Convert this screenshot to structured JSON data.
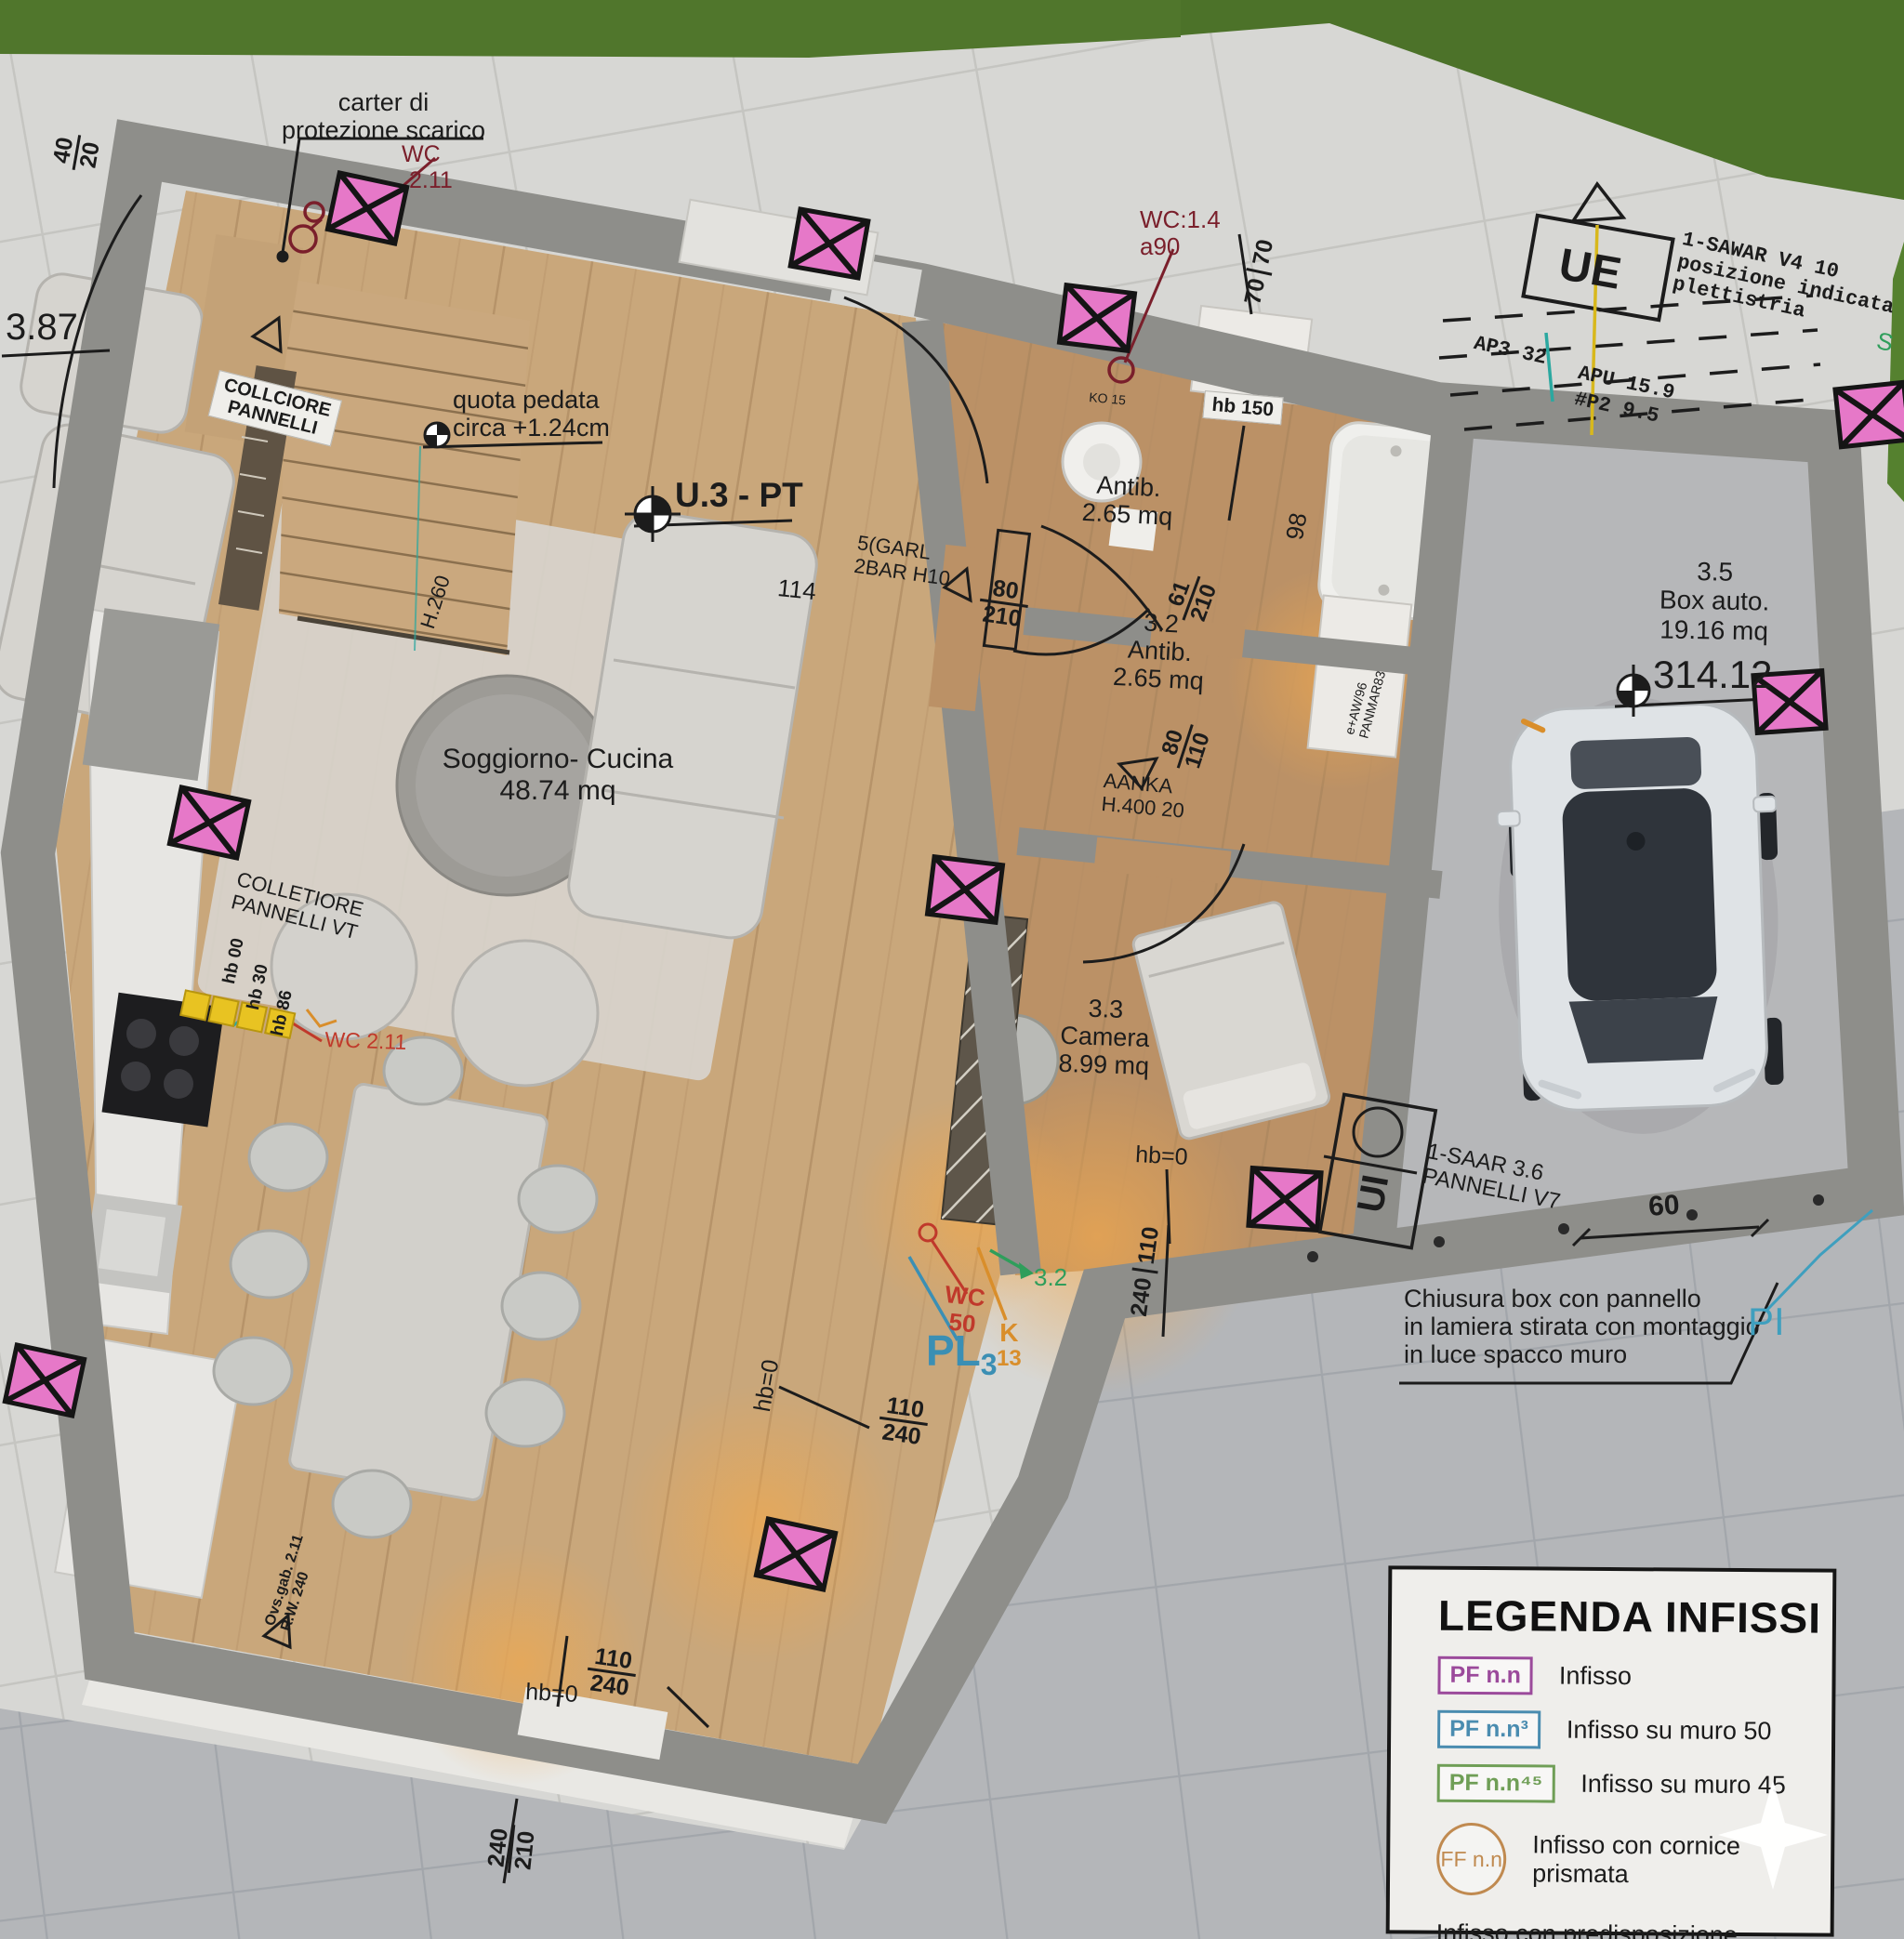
{
  "plan_title": "U.3 - PT",
  "rooms": {
    "living": {
      "name": "Soggiorno- Cucina",
      "area": "48.74 mq",
      "number": "114"
    },
    "antib1": {
      "name": "Antib.",
      "area": "2.65 mq",
      "side_dim": "98"
    },
    "antib2": {
      "number": "3.2",
      "name": "Antib.",
      "area": "2.65 mq"
    },
    "camera": {
      "number": "3.3",
      "name": "Camera",
      "area": "8.99 mq"
    },
    "garage": {
      "number": "3.5",
      "name": "Box auto.",
      "area": "19.16 mq",
      "spot_elevation": "314.12"
    }
  },
  "annotations": {
    "carter1": "carter di",
    "carter2": "protezione scarico",
    "wc_top1": "WC",
    "wc_top2": "2.11",
    "d387": "3.87",
    "collciore1": "COLLCIORE",
    "collciore2": "PANNELLI",
    "quota1": "quota pedata",
    "quota2": "circa +1.24cm",
    "h260": "H.260",
    "garl1": "5(GARL",
    "garl2": "2BAR H10",
    "wc14": "WC:1.4",
    "a90": "a90",
    "ko15": "KO 15",
    "hb150": "hb 150",
    "anka1": "AANKA",
    "anka2": "H.400  20",
    "wardrobe1": "e+AW/96",
    "wardrobe2": "PANMAR83",
    "ue": "UE",
    "sawar1": "1-SAWAR V4 10",
    "sawar2": "posizione indicata",
    "sawar3": "plettistria",
    "ap3": "AP3 32",
    "apu": "APU 15.9",
    "p2": "#P2 9.5",
    "s": "S",
    "colletiore1": "COLLETIORE",
    "colletiore2": "PANNELLI VT",
    "hb00": "hb 00",
    "hb30": "hb 30",
    "hb86": "hb 86",
    "wc_kitchen": "WC 2.11",
    "hb0": "hb=0",
    "ui": "UI",
    "saar1": "1-SAAR 3.6",
    "saar2": "PANNELLI V7",
    "chiusura1": "Chiusura box con pannello",
    "chiusura2": "in lamiera stirata con montaggio",
    "chiusura3": "in luce spacco muro",
    "pi": "PI",
    "pl": "PL",
    "pl_sub": "3",
    "k": "K",
    "k13": "13",
    "wc50a": "WC",
    "wc50b": "50",
    "g32": "3.2",
    "ovs1": "Ovs.gab. 2.11",
    "ovs2": "R.W. 240"
  },
  "dimensions": {
    "v40": "40",
    "v20": "20",
    "v70": "70",
    "v80": "80",
    "v210": "210",
    "v61": "61",
    "v110": "110",
    "v240": "240",
    "v98": "98",
    "v114": "114",
    "v60": "60"
  },
  "legend": {
    "title": "LEGENDA INFISSI",
    "items": [
      {
        "symbol": "PF n.n",
        "label": "Infisso",
        "color": "#9b4a9b",
        "style": "rect"
      },
      {
        "symbol": "PF n.n³",
        "label": "Infisso su muro 50",
        "color": "#4a8cb0",
        "style": "rect"
      },
      {
        "symbol": "PF n.n⁴⁵",
        "label": "Infisso su muro 45",
        "color": "#6f9e56",
        "style": "rect"
      },
      {
        "symbol": "FF n.n",
        "label": "Infisso con cornice prismata",
        "color": "#c08a50",
        "style": "circle"
      },
      {
        "symbol": "",
        "label": "Infisso con predisposizione infornata",
        "color": "",
        "style": "none"
      }
    ]
  },
  "colors": {
    "window_marker": "#e678c8",
    "annotation_dark_red": "#7a1f2b",
    "annotation_red": "#c0392b",
    "annotation_blue": "#3b8fb4",
    "annotation_orange": "#d98e2b",
    "annotation_green": "#2f9e5b",
    "annotation_cyan": "#3f9fbe",
    "accent_teal": "#2ba8a0",
    "accent_yellow": "#e8c322"
  }
}
